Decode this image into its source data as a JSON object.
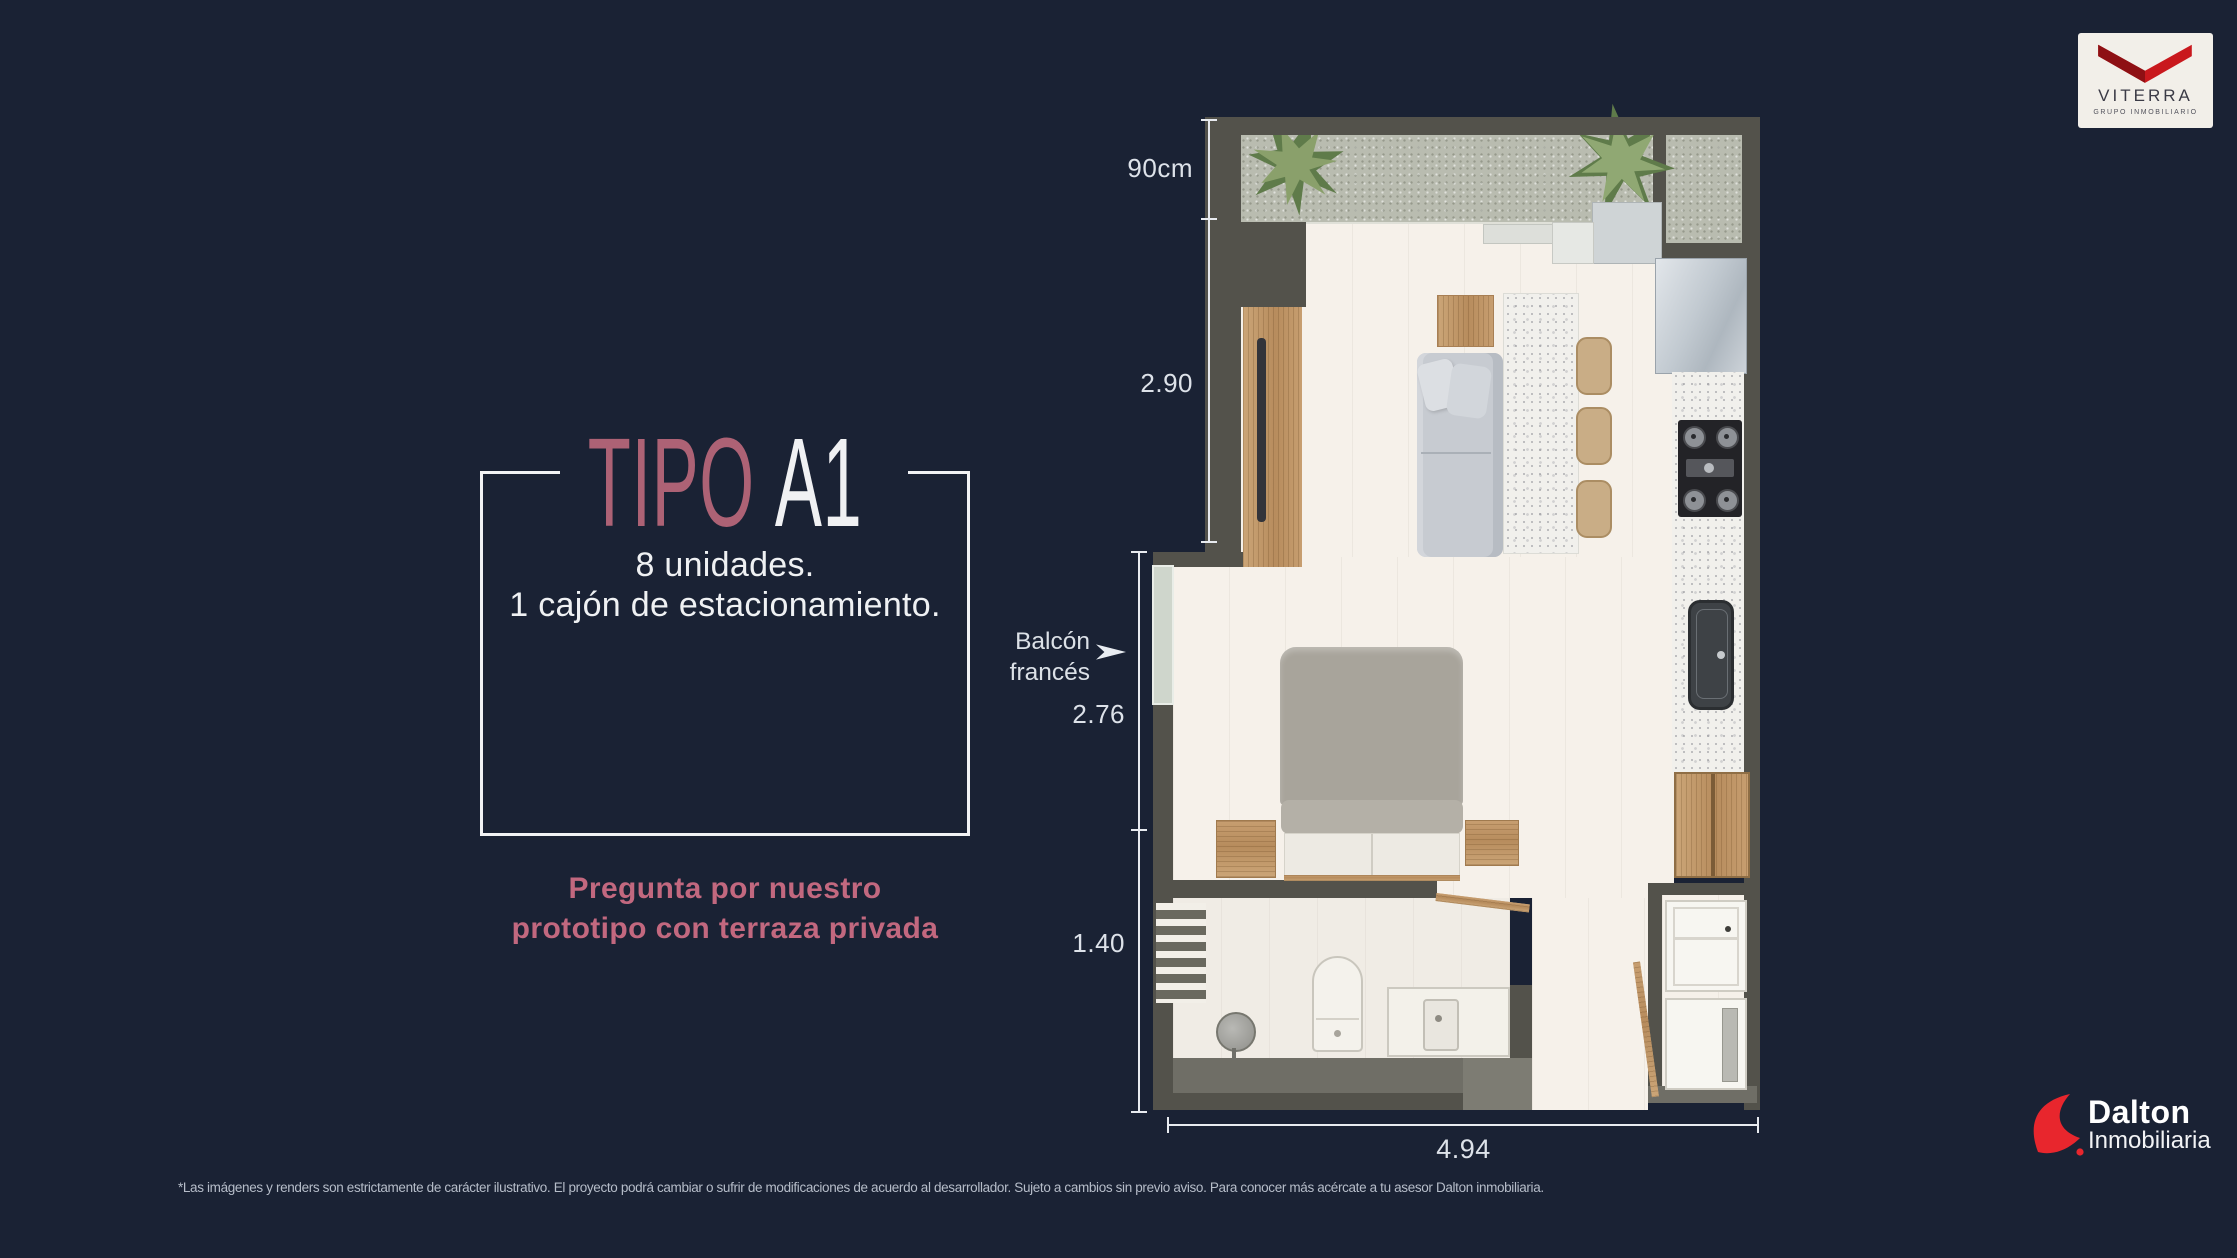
{
  "page": {
    "background": "#1a2234"
  },
  "viterra": {
    "name": "VITERRA",
    "tagline": "GRUPO INMOBILIARIO",
    "red": "#c9181d"
  },
  "dalton": {
    "name": "Dalton",
    "subtitle": "Inmobiliaria",
    "red": "#e8262d"
  },
  "title_block": {
    "word": "TIPO",
    "variant": "A1",
    "accent": "#ad6275",
    "line1": "8 unidades.",
    "line2": "1 cajón de estacionamiento."
  },
  "promo": {
    "line1": "Pregunta por nuestro",
    "line2": "prototipo con terraza privada",
    "color": "#c2687f"
  },
  "plan": {
    "balcony_label": {
      "line1": "Balcón",
      "line2": "francés"
    },
    "dims": {
      "terrace": "90cm",
      "living": "2.90",
      "bedroom": "2.76",
      "bath": "1.40",
      "width": "4.94"
    }
  },
  "disclaimer": "*Las imágenes y renders son estrictamente de carácter ilustrativo. El proyecto podrá cambiar o sufrir de modificaciones de acuerdo al desarrollador. Sujeto a cambios sin previo aviso. Para conocer más acércate a tu asesor Dalton inmobiliaria."
}
